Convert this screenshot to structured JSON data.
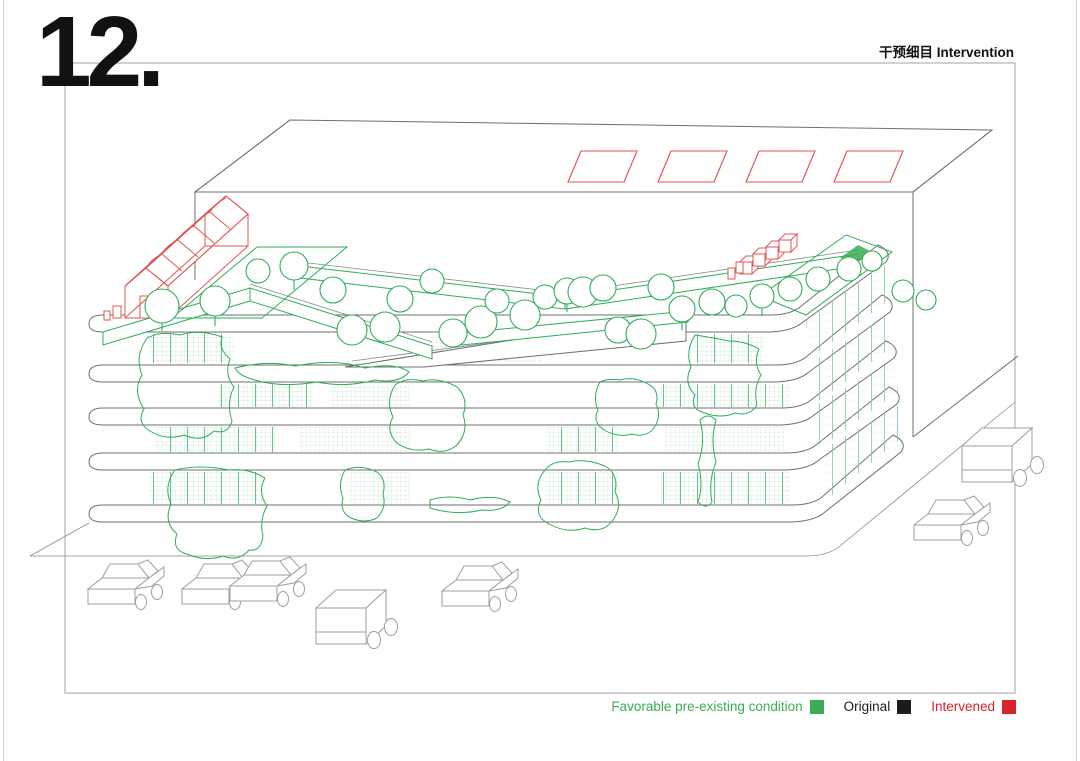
{
  "page": {
    "number": "12."
  },
  "header": {
    "title_zh": "干预细目",
    "title_en": "Intervention"
  },
  "legend": {
    "items": [
      {
        "label": "Favorable pre-existing condition",
        "color": "#3aad55"
      },
      {
        "label": "Original",
        "color": "#1c1c1c"
      },
      {
        "label": "Intervened",
        "color": "#d7242b"
      }
    ]
  },
  "colors": {
    "legend_green": "#3aad55",
    "legend_black": "#1c1c1c",
    "legend_red": "#d7242b",
    "green_line": "#2fae57",
    "red_line": "#e25555",
    "gray_line": "#6f6f6f",
    "car_line": "#9aa0a6"
  }
}
